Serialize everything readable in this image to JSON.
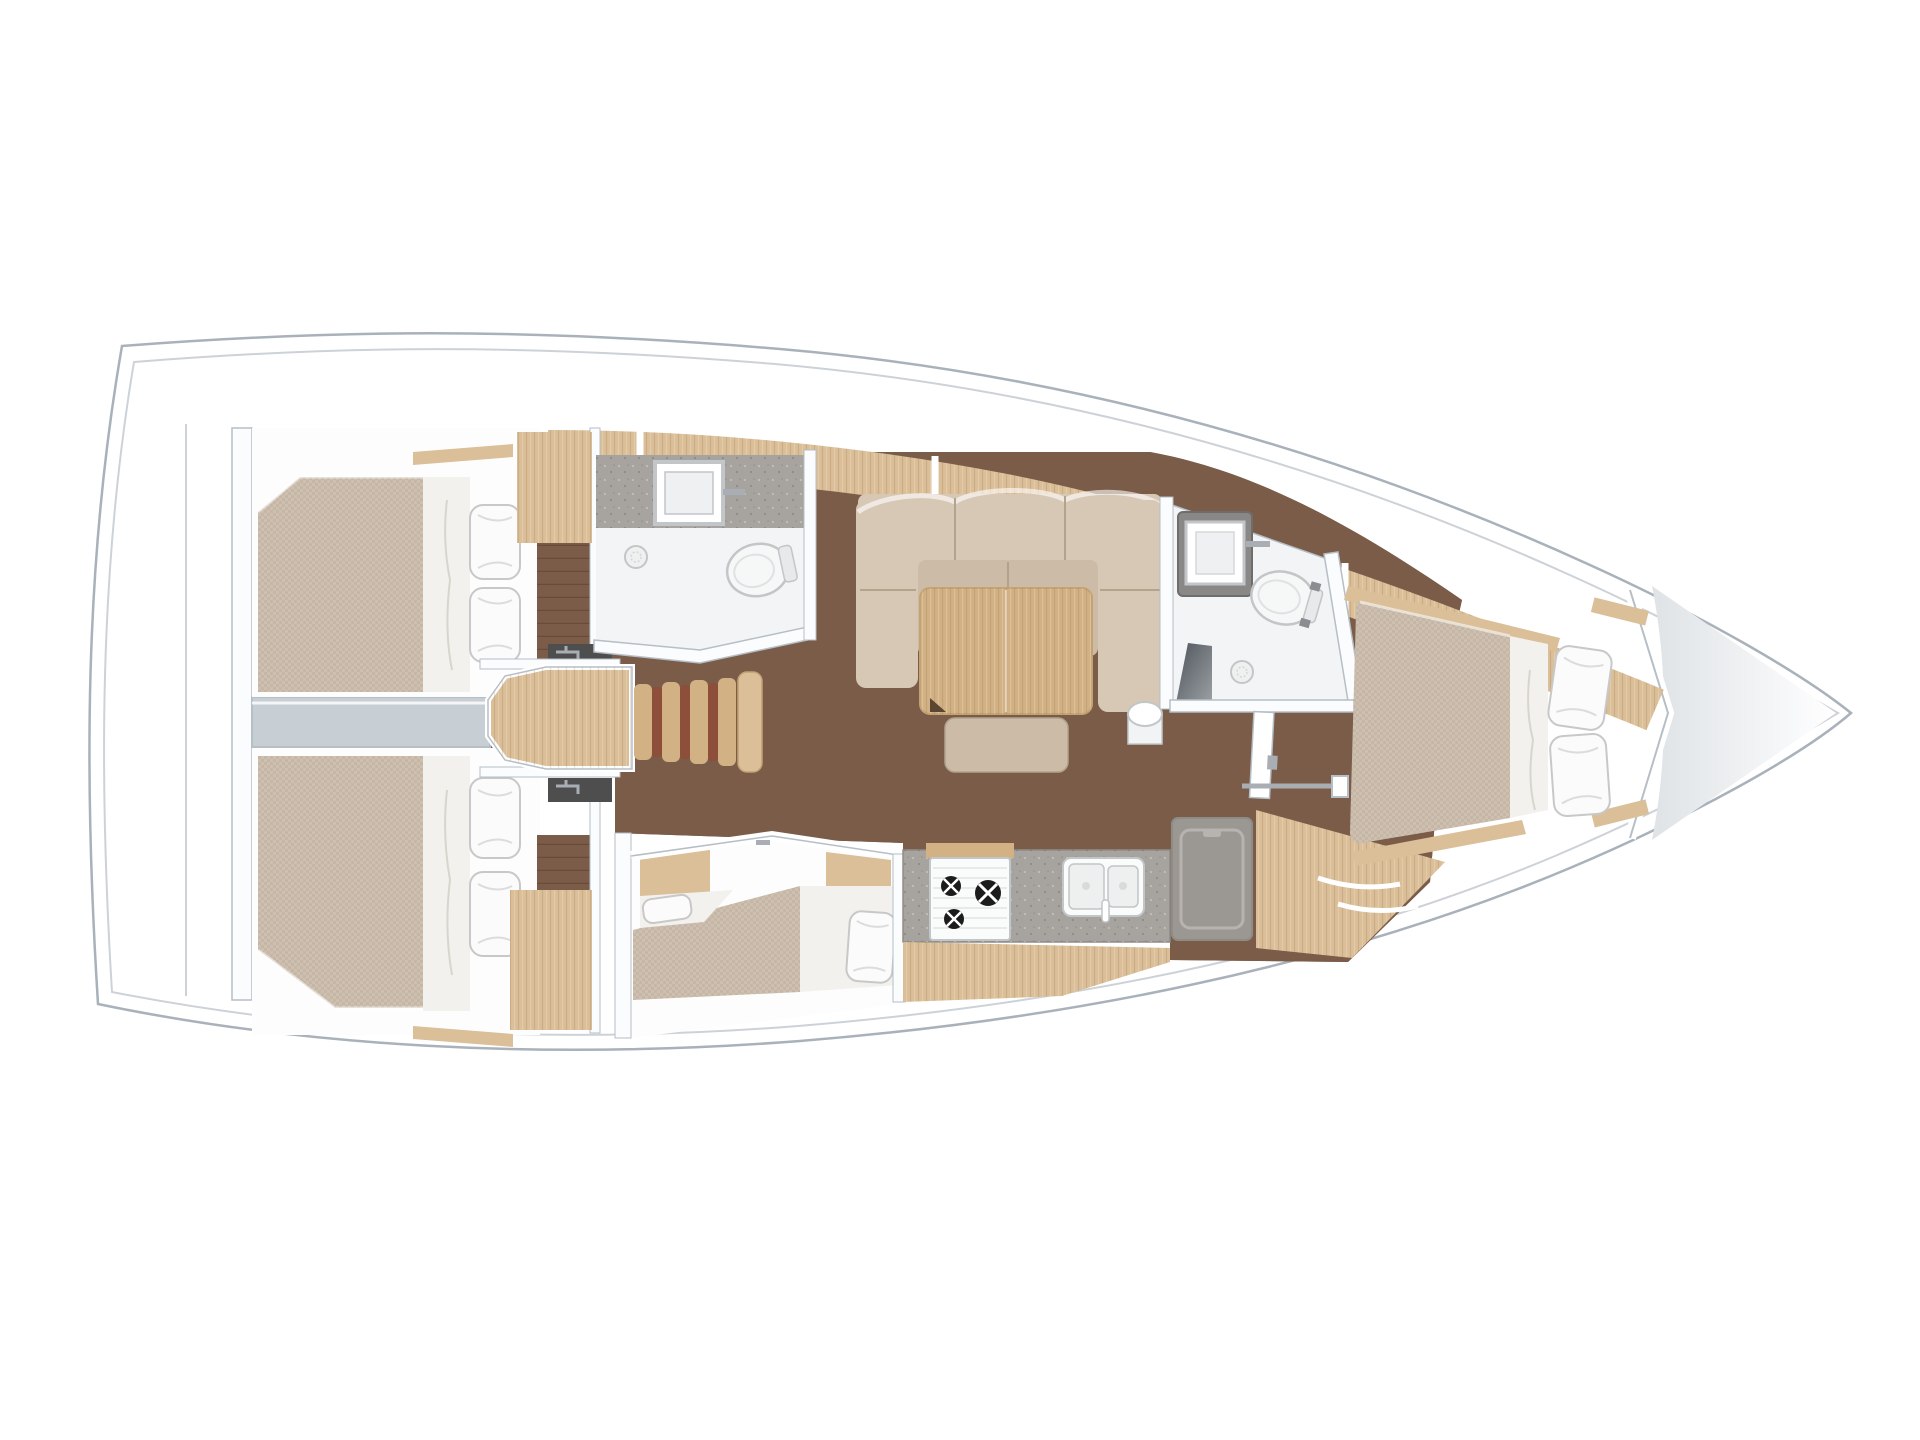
{
  "image": {
    "type": "yacht-interior-floor-plan",
    "orientation": "bow-right",
    "background": "#ffffff"
  },
  "palette": {
    "hull_outline": "#a9b1bb",
    "deck_line": "#cdd2d8",
    "wall": "#fbfcfd",
    "wall_edge": "#b6bec6",
    "floor_teak": "#7a5c48",
    "floor_line": "#68503e",
    "wood_light": "#dabf98",
    "wood_mid": "#d2b285",
    "wood_grain": "#c3a273",
    "stair_red": "#8d4f39",
    "mattress": "#cec0b0",
    "cushion_back": "#d7c8b6",
    "cushion_seat": "#ccbba7",
    "seam": "#b3a28c",
    "sheet": "#f2f1ed",
    "pillow": "#fbfbfb",
    "pillow_edge": "#c8c8c8",
    "engine_gray": "#c7ced4",
    "counter": "#a7a49f",
    "counter_edge": "#8f8c87",
    "fixture_white": "#f6f7f7",
    "fixture_edge": "#c2c6c8",
    "fridge": "#9b9792",
    "fridge_lid": "#b7b4af",
    "dark_bench": "#74797d",
    "vanity_dark": "#4e4e4e",
    "chrome": "#a8aeb3",
    "forepeak": "#eceef0",
    "head_floor": "#f2f4f5"
  },
  "areas": {
    "aft_cabin_port": {
      "features": [
        "double-berth",
        "two-pillows",
        "sheet-runner",
        "vanity-faucet",
        "wardrobe",
        "teak-floor-strip"
      ]
    },
    "aft_cabin_starboard": {
      "features": [
        "double-berth",
        "two-pillows",
        "sheet-runner",
        "vanity-faucet",
        "wardrobe",
        "teak-floor-strip"
      ]
    },
    "engine_compartment": {
      "features": [
        "engine-box-between-aft-cabins"
      ]
    },
    "companionway": {
      "features": [
        "landing-platform",
        "ladder-with-four-treads"
      ]
    },
    "aft_head": {
      "features": [
        "square-sink",
        "faucet",
        "toilet",
        "shower-drain",
        "angled-door-wall"
      ]
    },
    "salon": {
      "features": [
        "l-shaped-settee",
        "back-cushions",
        "folding-table",
        "bench-seat",
        "mast-post"
      ]
    },
    "galley": {
      "features": [
        "stove-three-burners",
        "double-sink-with-faucet",
        "top-loading-fridge",
        "stone-counter",
        "wood-cabinet-front"
      ]
    },
    "mid_cabin": {
      "features": [
        "double-berth",
        "two-pillows",
        "wood-lockers"
      ]
    },
    "forward_head": {
      "features": [
        "dark-vanity-with-square-sink",
        "toilet",
        "shower-drain",
        "shower-bench",
        "door",
        "towel-rail"
      ]
    },
    "forward_cabin": {
      "features": [
        "v-berth",
        "two-pillows",
        "sheet-runner",
        "wood-trim",
        "entry-steps"
      ]
    },
    "bow": {
      "features": [
        "anchor-locker-bulkhead",
        "forepeak"
      ]
    }
  },
  "counts": {
    "pillows_total": 8,
    "stove_burners": 3,
    "sinks": 4,
    "toilets": 2,
    "cabins": 4
  }
}
